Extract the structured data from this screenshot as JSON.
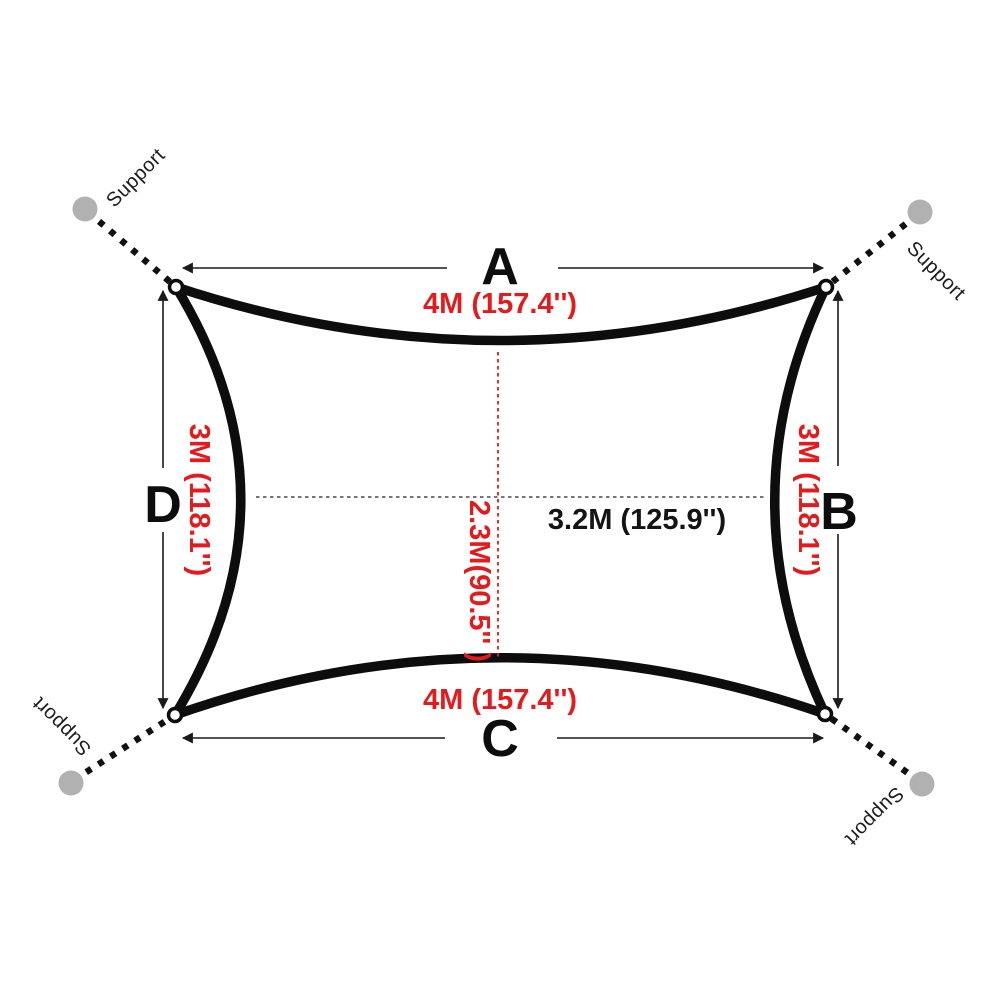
{
  "diagram": {
    "kind": "shade-sail-dimension-diagram",
    "colors": {
      "dimension_text_red": "#e31b1c",
      "outline": "#0d0d0d",
      "support_dot_gray": "#b1b1b1",
      "midline_gray": "#4a4a4a"
    },
    "sail": {
      "side_a": {
        "label": "A",
        "dimension": "4M (157.4'')"
      },
      "side_b": {
        "label": "B",
        "dimension": "3M (118.1'')"
      },
      "side_c": {
        "label": "C",
        "dimension": "4M (157.4'')"
      },
      "side_d": {
        "label": "D",
        "dimension": "3M (118.1'')"
      },
      "diagonal_width": "3.2M (125.9'')",
      "diagonal_height": "2.3M(90.5'' )"
    },
    "supports": {
      "top_left": "Support",
      "top_right": "Support",
      "bottom_left": "Support",
      "bottom_right": "Support"
    }
  }
}
